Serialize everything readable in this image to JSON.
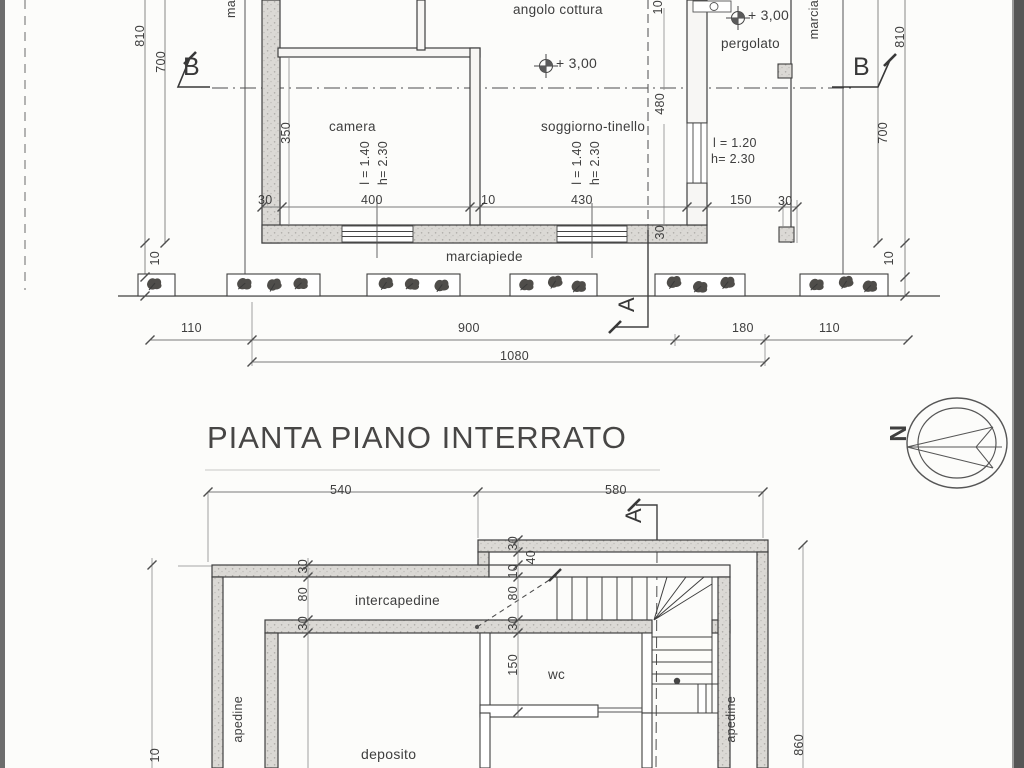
{
  "scan": {
    "title": "PIANTA PIANO INTERRATO"
  },
  "colors": {
    "ink": "#3c3c3c",
    "wall_fill": "#dbd9d5",
    "scan_edge": "#5a5a5a"
  },
  "compass": {
    "north_letter": "N"
  },
  "top_plan": {
    "rooms": {
      "angolo_cottura": "angolo cottura",
      "camera": "camera",
      "soggiorno": "soggiorno-tinello",
      "pergolato": "pergolato"
    },
    "levels": {
      "soggiorno": "+ 3,00",
      "pergolato": "+ 3,00"
    },
    "specs": {
      "camera_l": "l = 1.40",
      "camera_h": "h= 2.30",
      "soggiorno_l": "l = 1.40",
      "soggiorno_h": "h= 2.30",
      "pergolato_l": "l = 1.20",
      "pergolato_h": "h= 2.30"
    },
    "texts": {
      "marciapiede": "marciapiede",
      "marcia_right": "marcia",
      "marcia_left_cut": "ma"
    },
    "sections": {
      "b_left": "B",
      "b_right": "B",
      "a": "A"
    },
    "dims": {
      "left_810": "810",
      "left_700": "700",
      "left_10": "10",
      "right_810": "810",
      "right_700": "700",
      "right_10": "10",
      "cam_350": "350",
      "sog_480": "480",
      "top_10": "10",
      "wall_30": "30",
      "row1_30": "30",
      "row1_400": "400",
      "row1_10": "10",
      "row1_430": "430",
      "row1_150": "150",
      "row1_30b": "30",
      "row2_110a": "110",
      "row2_900": "900",
      "row2_180": "180",
      "row2_110b": "110",
      "row2_1080": "1080"
    }
  },
  "bottom_plan": {
    "rooms": {
      "intercapedine": "intercapedine",
      "wc": "wc",
      "deposito": "deposito"
    },
    "texts": {
      "intercapedine_left_cut": "apedine",
      "intercapedine_right_cut": "apedine"
    },
    "sections": {
      "a": "A"
    },
    "dims": {
      "top_540": "540",
      "top_580": "580",
      "left_30": "30",
      "left_80": "80",
      "left_30b": "30",
      "mid_30": "30",
      "mid_10": "10",
      "mid_80": "80",
      "mid_30b": "30",
      "mid_150": "150",
      "mid_40": "40",
      "right_860": "860",
      "left_edge_10": "10"
    }
  }
}
